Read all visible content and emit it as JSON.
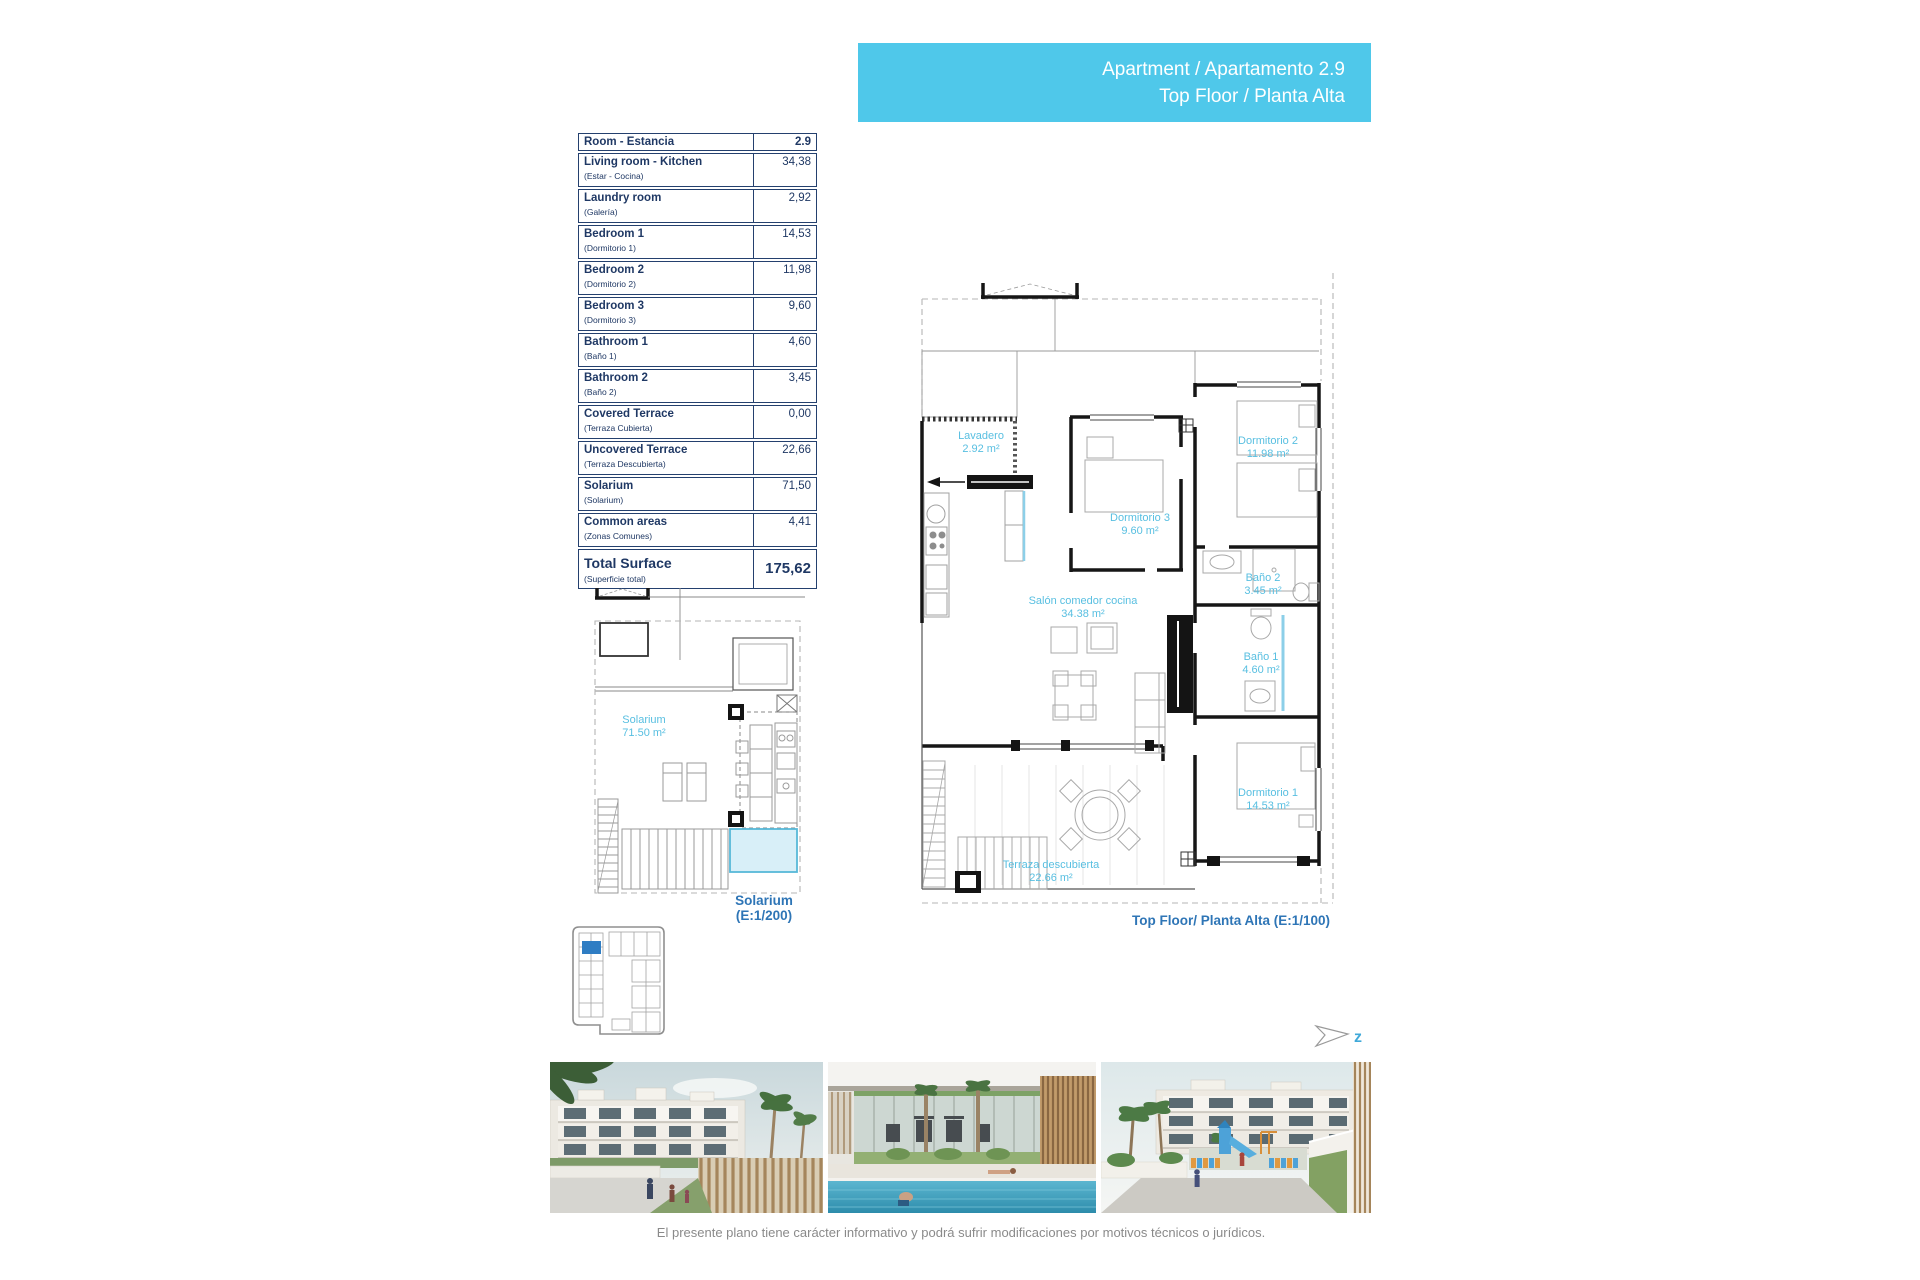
{
  "banner": {
    "line1": "Apartment / Apartamento 2.9",
    "line2": "Top Floor / Planta Alta"
  },
  "table": {
    "header": {
      "name": "Room - Estancia",
      "value": "2.9"
    },
    "rows": [
      {
        "name": "Living room - Kitchen",
        "sub": "(Estar - Cocina)",
        "value": "34,38"
      },
      {
        "name": "Laundry room",
        "sub": "(Galería)",
        "value": "2,92"
      },
      {
        "name": "Bedroom 1",
        "sub": "(Dormitorio 1)",
        "value": "14,53"
      },
      {
        "name": "Bedroom 2",
        "sub": "(Dormitorio 2)",
        "value": "11,98"
      },
      {
        "name": "Bedroom 3",
        "sub": "(Dormitorio 3)",
        "value": "9,60"
      },
      {
        "name": "Bathroom 1",
        "sub": "(Baño 1)",
        "value": "4,60"
      },
      {
        "name": "Bathroom 2",
        "sub": "(Baño 2)",
        "value": "3,45"
      },
      {
        "name": "Covered Terrace",
        "sub": "(Terraza Cubierta)",
        "value": "0,00"
      },
      {
        "name": "Uncovered Terrace",
        "sub": "(Terraza Descubierta)",
        "value": "22,66"
      },
      {
        "name": "Solarium",
        "sub": "(Solarium)",
        "value": "71,50"
      },
      {
        "name": "Common areas",
        "sub": "(Zonas Comunes)",
        "value": "4,41"
      }
    ],
    "total": {
      "name": "Total Surface",
      "sub": "(Superficie total)",
      "value": "175,62"
    }
  },
  "main_plan": {
    "caption": "Top Floor/ Planta Alta (E:1/100)",
    "rooms": [
      {
        "label": "Lavadero",
        "area": "2.92 m²"
      },
      {
        "label": "Dormitorio 3",
        "area": "9.60 m²"
      },
      {
        "label": "Dormitorio 2",
        "area": "11.98 m²"
      },
      {
        "label": "Baño 2",
        "area": "3.45 m²"
      },
      {
        "label": "Baño 1",
        "area": "4.60 m²"
      },
      {
        "label": "Salón comedor cocina",
        "area": "34.38 m²"
      },
      {
        "label": "Dormitorio 1",
        "area": "14.53 m²"
      },
      {
        "label": "Terraza descubierta",
        "area": "22.66 m²"
      }
    ]
  },
  "solarium_plan": {
    "room_label": "Solarium",
    "room_area": "71.50 m²",
    "caption_line1": "Solarium",
    "caption_line2": "(E:1/200)"
  },
  "north_indicator": {
    "letter": "z"
  },
  "footer": {
    "disclaimer": "El presente plano tiene carácter informativo y podrá sufrir modificaciones por motivos técnicos o jurídicos."
  },
  "photos": [
    {
      "name": "apartment-exterior-render"
    },
    {
      "name": "pool-gym-render"
    },
    {
      "name": "playground-render"
    }
  ],
  "colors": {
    "banner_bg": "#4fc8ea",
    "table_ink": "#1f3864",
    "room_label_cyan": "#58bfe1",
    "caption_blue": "#2e75b6",
    "keyplan_unit_blue": "#2f7dc3",
    "disclaimer_gray": "#8a8a8a"
  }
}
